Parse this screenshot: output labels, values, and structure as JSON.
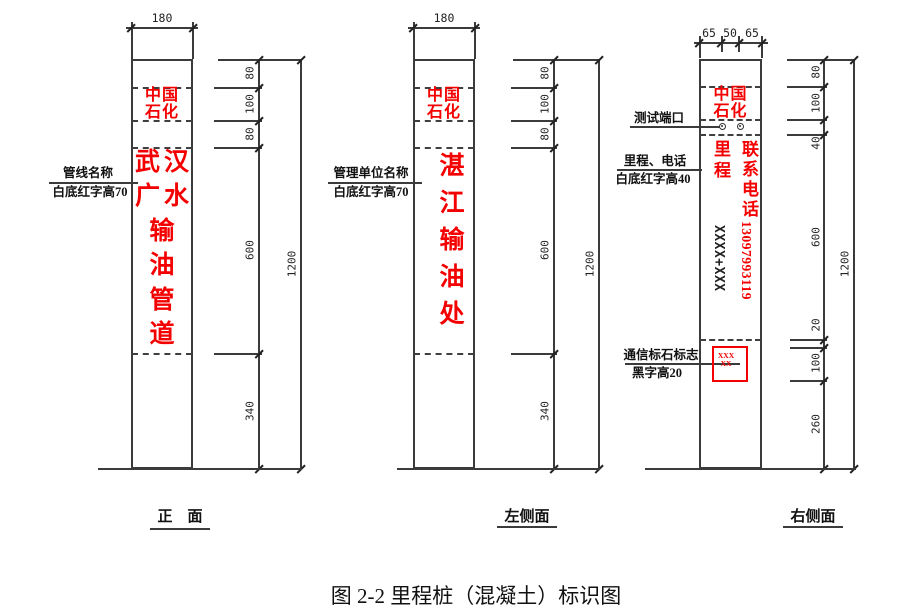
{
  "figure": {
    "caption": "图 2-2 里程桩（混凝土）标识图"
  },
  "colors": {
    "accent_red": "#f40000",
    "line_color": "#3b3b3b"
  },
  "views": {
    "front": {
      "label": "正　面",
      "top_dim": "180",
      "logo": {
        "line1": "中国",
        "line2": "石化"
      },
      "name_chars": [
        "武",
        "汉",
        "广",
        "水",
        "输",
        "油",
        "管",
        "道"
      ],
      "annotation": {
        "line1": "管线名称",
        "line2": "白底红字高70"
      },
      "dims": {
        "chain": [
          "80",
          "100",
          "80",
          "600",
          "340"
        ],
        "overall": "1200"
      }
    },
    "left_side": {
      "label": "左侧面",
      "top_dim": "180",
      "logo": {
        "line1": "中国",
        "line2": "石化"
      },
      "name": "湛江输油处",
      "annotation": {
        "line1": "管理单位名称",
        "line2": "白底红字高70"
      },
      "dims": {
        "chain": [
          "80",
          "100",
          "80",
          "600",
          "340"
        ],
        "overall": "1200"
      }
    },
    "right_side": {
      "label": "右侧面",
      "top_dims": [
        "65",
        "50",
        "65"
      ],
      "logo": {
        "line1": "中国",
        "line2": "石化"
      },
      "test_port_label": "测试端口",
      "mileage_annotation": {
        "line1": "里程、电话",
        "line2": "白底红字高40"
      },
      "mileage_title": "里程",
      "phone_title": "联系电话",
      "phone_number": "13097993119",
      "mileage_value": "XXXX+XXX",
      "marker_annotation": {
        "line1": "通信标石标志",
        "line2": "黑字高20"
      },
      "marker_box": {
        "line1": "XXX",
        "line2": "XX"
      },
      "dims": {
        "chain": [
          "80",
          "100",
          "40",
          "600",
          "20",
          "100",
          "260"
        ],
        "overall": "1200"
      }
    }
  }
}
